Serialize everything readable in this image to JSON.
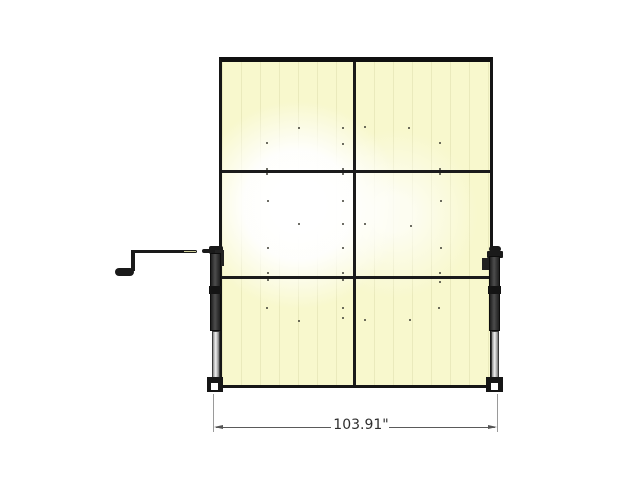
{
  "dimension": {
    "label": "103.91\""
  },
  "colors": {
    "background": "#ffffff",
    "panel_fill": "#f8f8cd",
    "panel_glow": "#ffffff",
    "frame_line": "#101010",
    "seam_line": "#1b1b1b",
    "jack_body": "#1f1f1f",
    "jack_inner_tube": "#c9c9c9",
    "crank": "#1a1a1a",
    "dimension_line": "#5a5a5a",
    "dimension_text": "#2f2f2f",
    "fastener_dot": "#3f3f35"
  },
  "fasteners": [
    [
      299,
      128
    ],
    [
      343,
      128
    ],
    [
      365,
      127
    ],
    [
      409,
      128
    ],
    [
      267,
      143
    ],
    [
      343,
      144
    ],
    [
      440,
      143
    ],
    [
      267,
      169
    ],
    [
      343,
      169
    ],
    [
      440,
      169
    ],
    [
      267,
      174
    ],
    [
      343,
      174
    ],
    [
      440,
      174
    ],
    [
      268,
      201
    ],
    [
      343,
      201
    ],
    [
      441,
      201
    ],
    [
      299,
      224
    ],
    [
      343,
      224
    ],
    [
      365,
      224
    ],
    [
      411,
      226
    ],
    [
      268,
      248
    ],
    [
      343,
      248
    ],
    [
      441,
      248
    ],
    [
      268,
      273
    ],
    [
      343,
      273
    ],
    [
      440,
      273
    ],
    [
      268,
      280
    ],
    [
      343,
      280
    ],
    [
      440,
      282
    ],
    [
      267,
      308
    ],
    [
      343,
      308
    ],
    [
      439,
      308
    ],
    [
      299,
      321
    ],
    [
      343,
      318
    ],
    [
      365,
      320
    ],
    [
      410,
      320
    ]
  ]
}
